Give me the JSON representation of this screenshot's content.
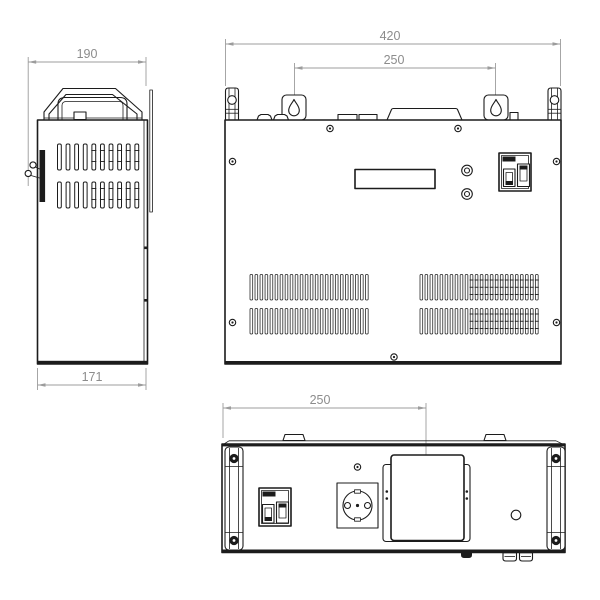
{
  "drawing": {
    "views": {
      "side": {
        "dim_top": "190",
        "dim_bottom": "171"
      },
      "front": {
        "dim_overall_width": "420",
        "dim_mount_holes_spacing": "250"
      },
      "back": {
        "dim_terminal_offset": "250"
      }
    }
  },
  "colors": {
    "line": "#1c1c1c",
    "dim_line": "#9c9c9c",
    "dim_text": "#8c8c8c",
    "background": "#ffffff"
  }
}
